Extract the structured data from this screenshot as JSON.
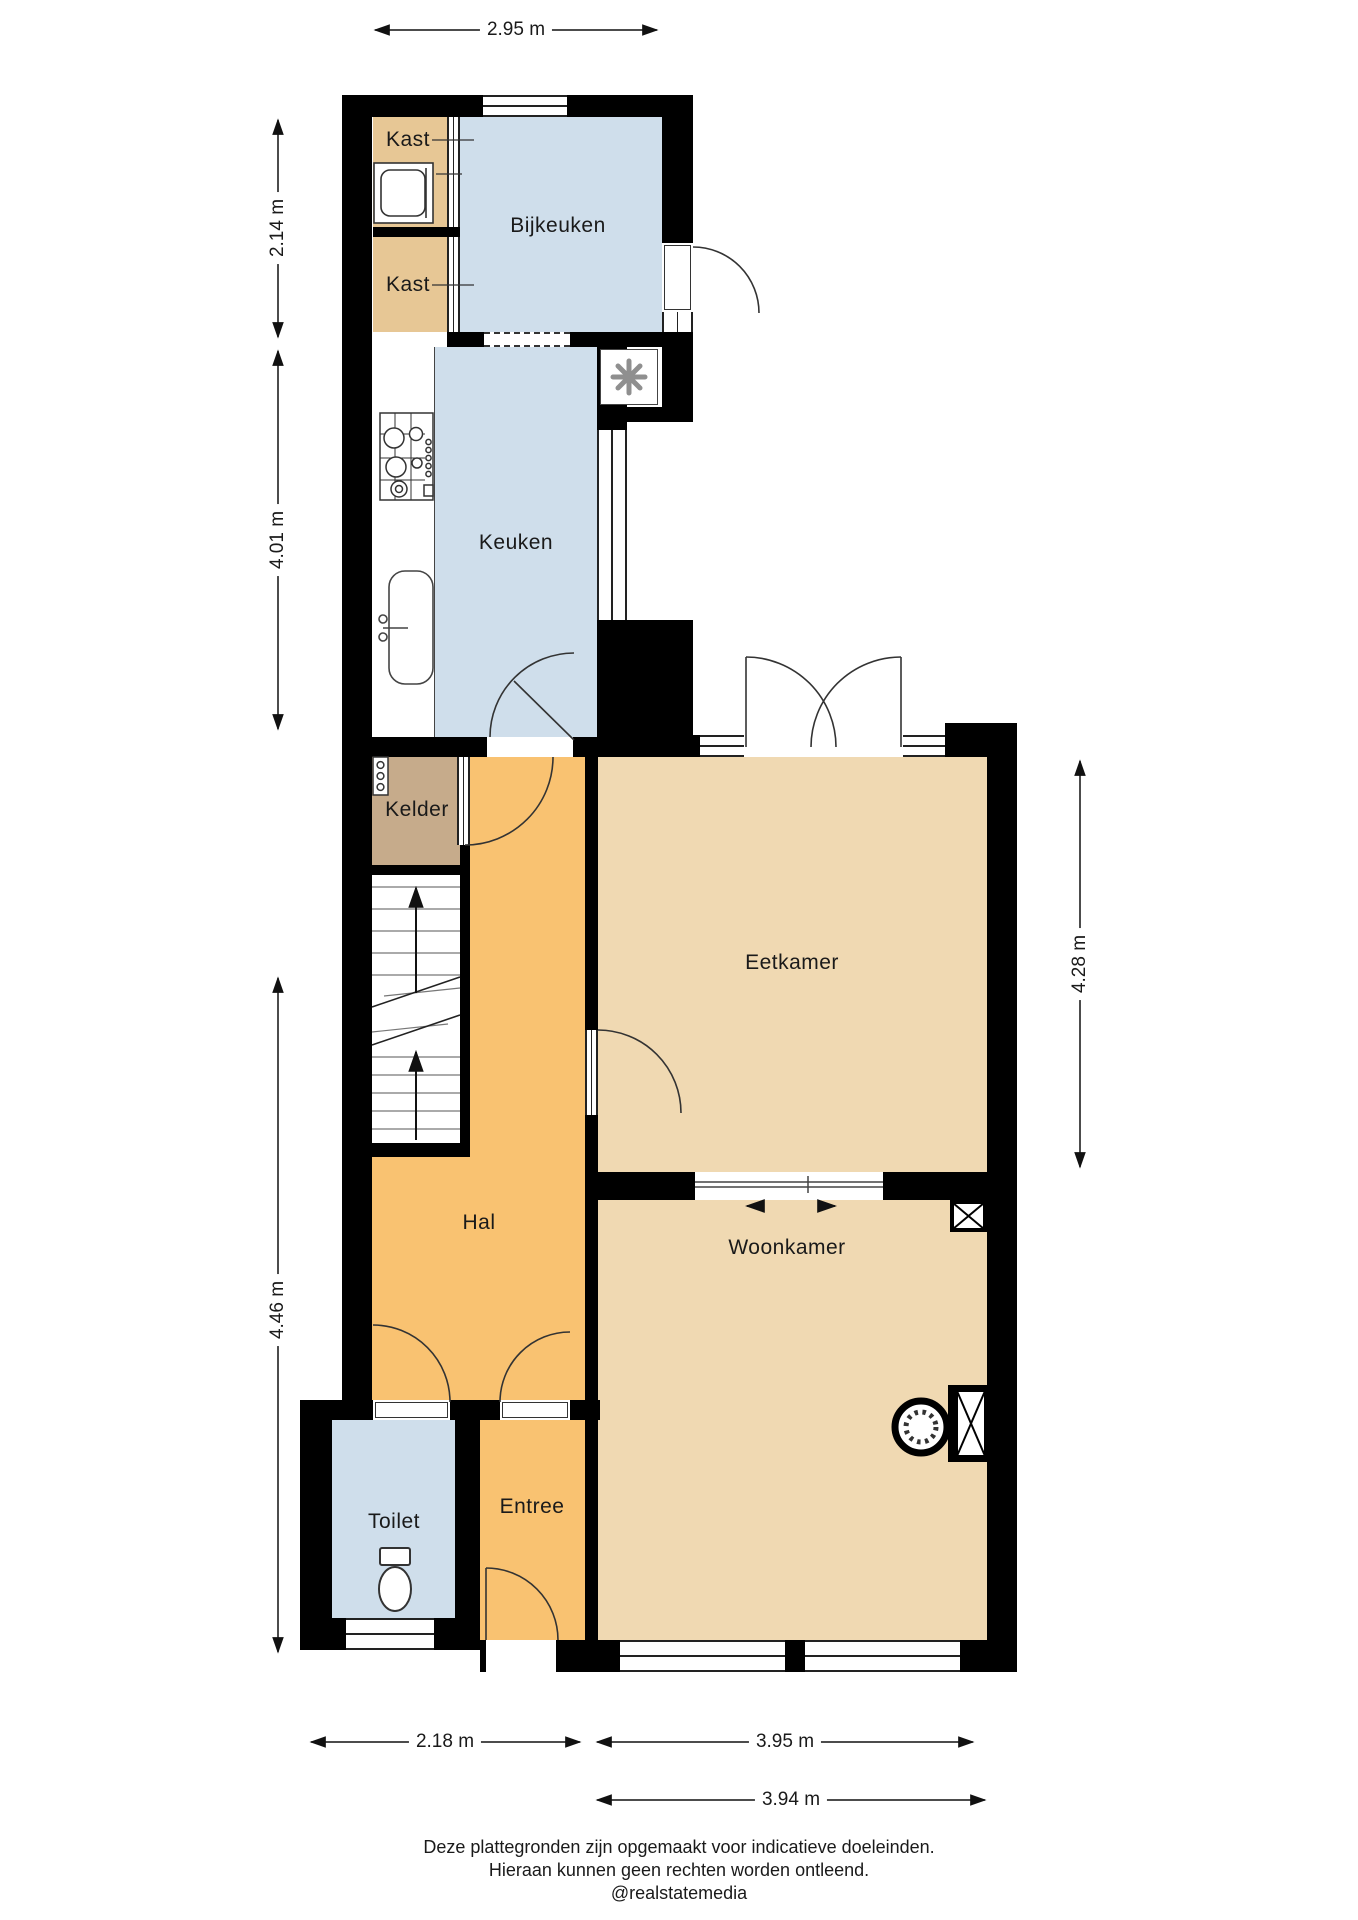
{
  "floorplan": {
    "rooms": {
      "kast1": {
        "label": "Kast"
      },
      "kast2": {
        "label": "Kast"
      },
      "bijkeuken": {
        "label": "Bijkeuken"
      },
      "keuken": {
        "label": "Keuken"
      },
      "kelder": {
        "label": "Kelder"
      },
      "eetkamer": {
        "label": "Eetkamer"
      },
      "hal": {
        "label": "Hal"
      },
      "woonkamer": {
        "label": "Woonkamer"
      },
      "toilet": {
        "label": "Toilet"
      },
      "entree": {
        "label": "Entree"
      }
    },
    "dimensions": {
      "top": "2.95 m",
      "left_top": "2.14 m",
      "left_middle": "4.01 m",
      "left_bottom": "4.46 m",
      "right": "4.28 m",
      "bottom_left": "2.18 m",
      "bottom_right": "3.95 m",
      "bottom_lower": "3.94 m"
    },
    "footer": {
      "line1": "Deze plattegronden zijn opgemaakt voor indicatieve doeleinden.",
      "line2": "Hieraan kunnen geen rechten worden ontleend.",
      "line3": "@realstatemedia"
    },
    "colors": {
      "wall": "#000000",
      "floor_blue": "#cfdeeb",
      "floor_beige": "#f0d9b2",
      "floor_tan": "#e7c795",
      "floor_orange": "#f9c271",
      "floor_kelder": "#c6ab8b"
    }
  }
}
